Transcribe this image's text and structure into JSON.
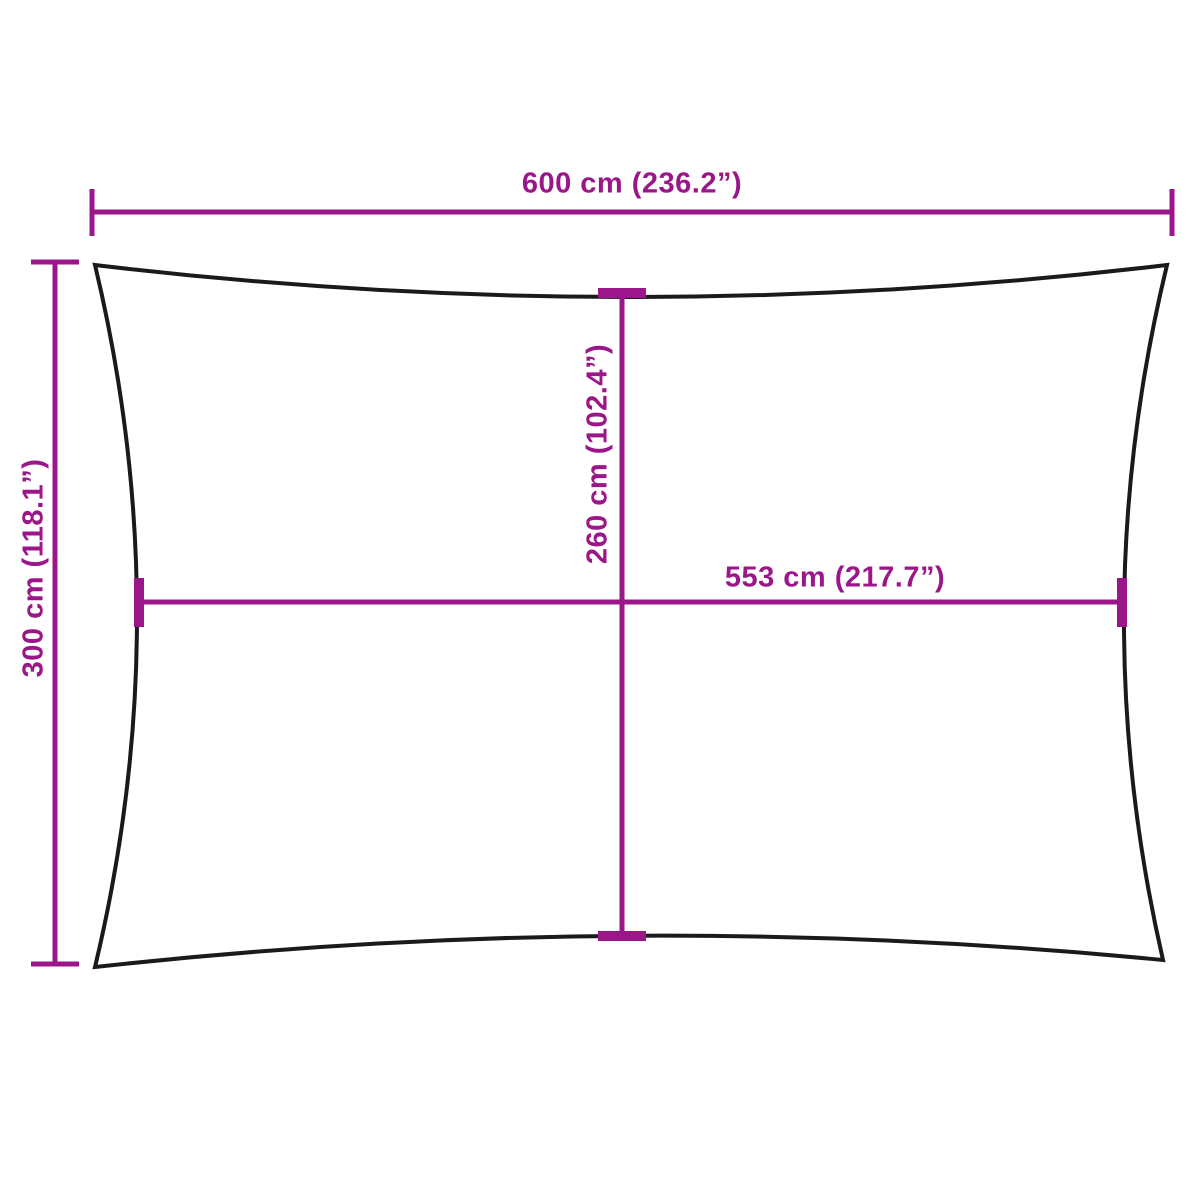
{
  "colors": {
    "accent": "#9B1688",
    "outline": "#1A1A1A",
    "background": "#FFFFFF"
  },
  "diagram": {
    "shape": "rectangular shade sail with concave edges",
    "dimensions": {
      "top_width": "600 cm (236.2”)",
      "left_height": "300 cm (118.1”)",
      "center_height": "260 cm (102.4”)",
      "center_width": "553 cm (217.7”)"
    }
  }
}
